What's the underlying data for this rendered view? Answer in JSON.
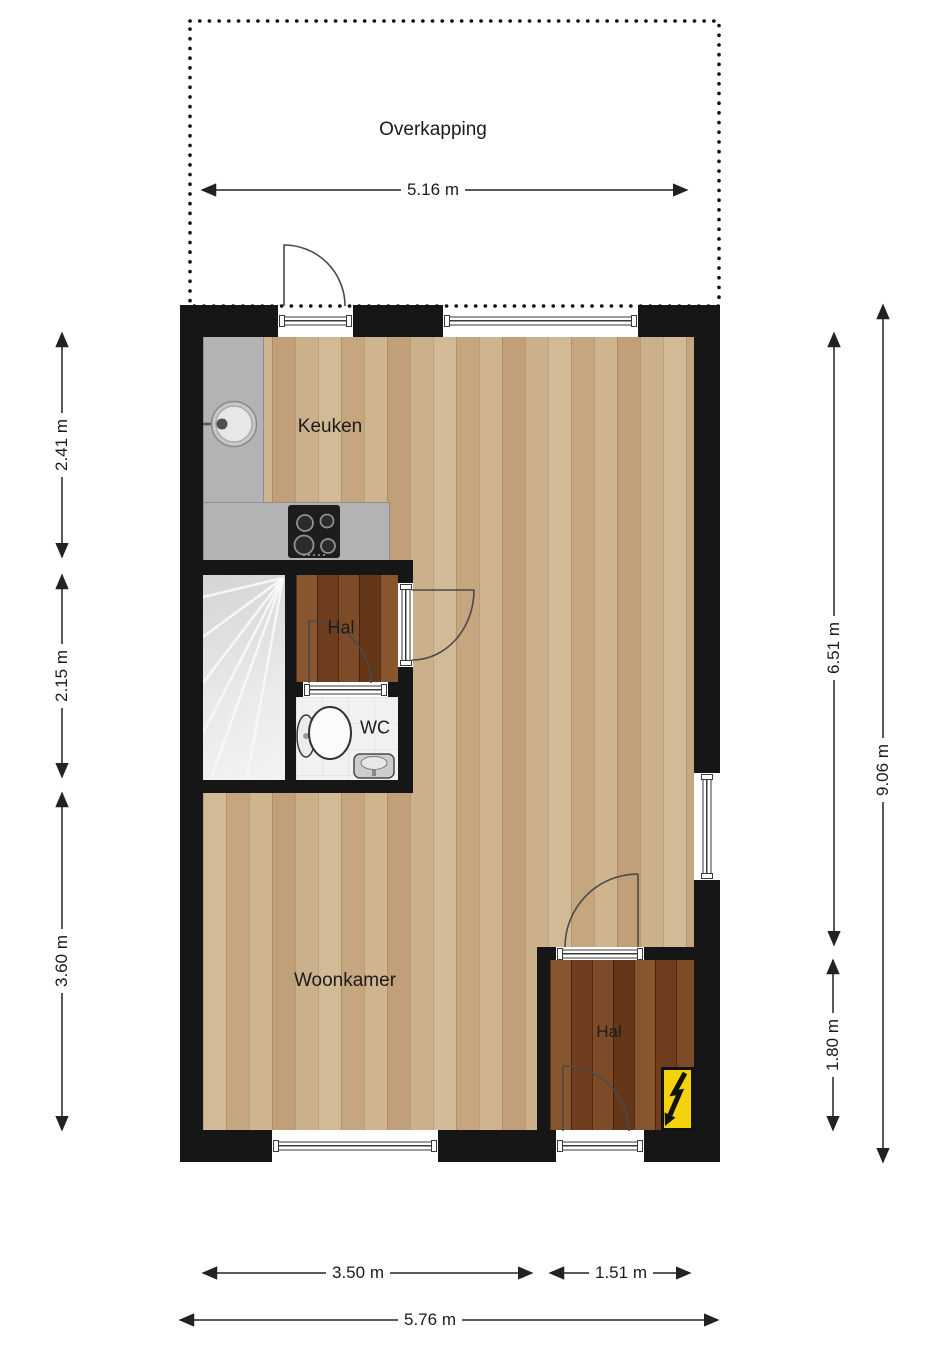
{
  "plan": {
    "type": "floor-plan",
    "rooms": {
      "overkapping": {
        "label": "Overkapping"
      },
      "keuken": {
        "label": "Keuken"
      },
      "hal_upper": {
        "label": "Hal"
      },
      "wc": {
        "label": "WC"
      },
      "woonkamer": {
        "label": "Woonkamer"
      },
      "hal_lower": {
        "label": "Hal"
      }
    },
    "dimensions": {
      "overkapping_width": "5.16 m",
      "keuken_depth": "2.41 m",
      "stairs_zone_depth": "2.15 m",
      "woonkamer_depth": "3.60 m",
      "interior_height": "6.51 m",
      "exterior_height": "9.06 m",
      "hal_lower_depth": "1.80 m",
      "woonkamer_width": "3.50 m",
      "hal_lower_width": "1.51 m",
      "exterior_width": "5.76 m"
    },
    "icons": {
      "electrical_panel": "lightning-bolt",
      "fixtures": [
        "kitchen-sink",
        "stove-4-burners",
        "toilet",
        "wc-sink",
        "winder-stairs"
      ]
    },
    "colors": {
      "wall": "#161616",
      "wood_light": "#cbae89",
      "wood_dark": "#7a4a28",
      "counter": "#b3b3b3",
      "stairs": "#e6e6e6",
      "wc_floor": "#f1f1f1",
      "electrical_panel": "#f6d20a",
      "dimension_lines": "#222222"
    }
  }
}
